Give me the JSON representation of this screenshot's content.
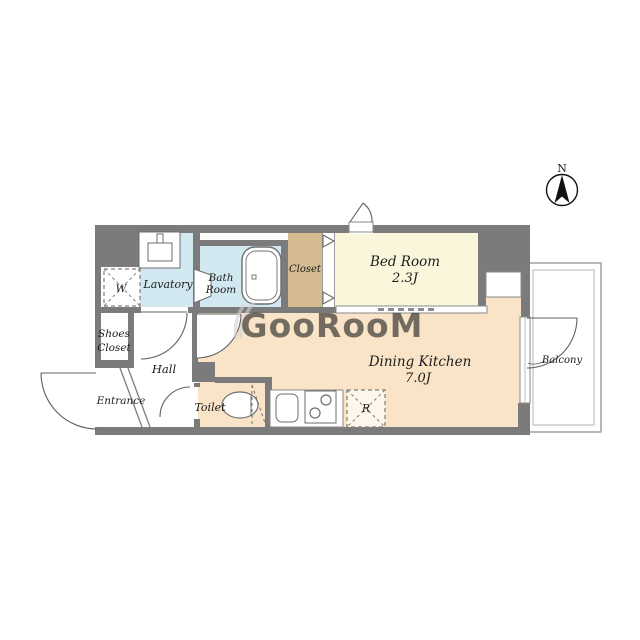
{
  "watermark": {
    "text": "GooRooM"
  },
  "compass": {
    "label": "N"
  },
  "rooms": {
    "bedroom": {
      "label": "Bed Room",
      "size": "2.3J"
    },
    "dining_kitchen": {
      "label": "Dining Kitchen",
      "size": "7.0J"
    },
    "closet": {
      "label": "Closet"
    },
    "bathroom": {
      "line1": "Bath",
      "line2": "Room"
    },
    "lavatory": {
      "label": "Lavatory"
    },
    "toilet": {
      "label": "Toilet"
    },
    "hall": {
      "label": "Hall"
    },
    "entrance": {
      "label": "Entrance"
    },
    "shoes_closet": {
      "line1": "Shoes",
      "line2": "Closet"
    },
    "balcony": {
      "label": "Balcony"
    }
  },
  "fixtures": {
    "washer_mark": "W",
    "refrigerator_mark": "R"
  },
  "colors": {
    "wall": "#7b7b7b",
    "bedroom_floor": "#faf6dc",
    "dining_floor": "#f9e4c8",
    "wet_floor": "#d2e8f1",
    "closet_floor": "#d5bc90",
    "watermark": "#d2d2d2",
    "line": "#5f5f5f"
  }
}
